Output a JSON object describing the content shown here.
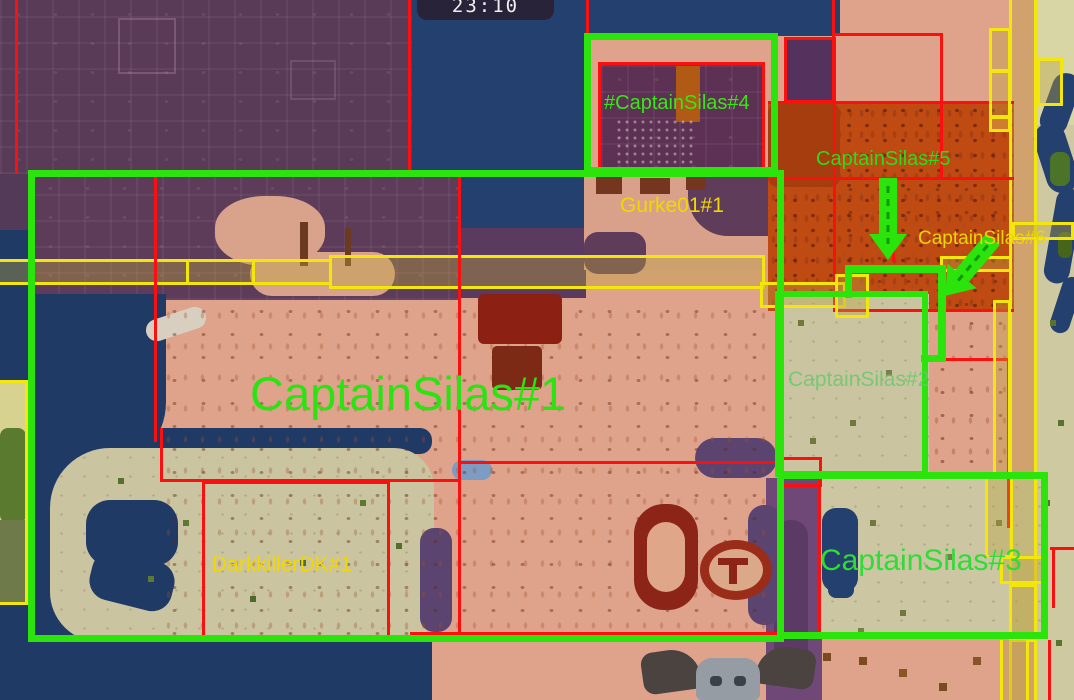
{
  "hud": {
    "clock": "23:10"
  },
  "labels": {
    "silas4": {
      "text": "#CaptainSilas#4"
    },
    "gurke": {
      "text": "Gurke01#1"
    },
    "silas5": {
      "text": "CaptainSilas#5"
    },
    "silas6": {
      "text": "CaptainSilas#6"
    },
    "silas1": {
      "text": "CaptainSilas#1"
    },
    "silas2": {
      "text": "CaptainSilas#2"
    },
    "darkkiller": {
      "text": "DarkkillerDK#1"
    },
    "silas3": {
      "text": "CaptainSilas#3"
    }
  },
  "palette": {
    "highlight_border": "#2be40c",
    "claim_border": "#fb1010",
    "road_border": "#f2e60c",
    "label_green": "#2ee214",
    "label_yellow": "#f0d800",
    "label_faded_green": "#64c96b",
    "water": "#24406e",
    "terrain_salmon": "#dfa28b",
    "terrain_desert": "#ccc5a2",
    "terrain_badlands": "#bf4a12",
    "terrain_dark_purple": "#593a57"
  }
}
